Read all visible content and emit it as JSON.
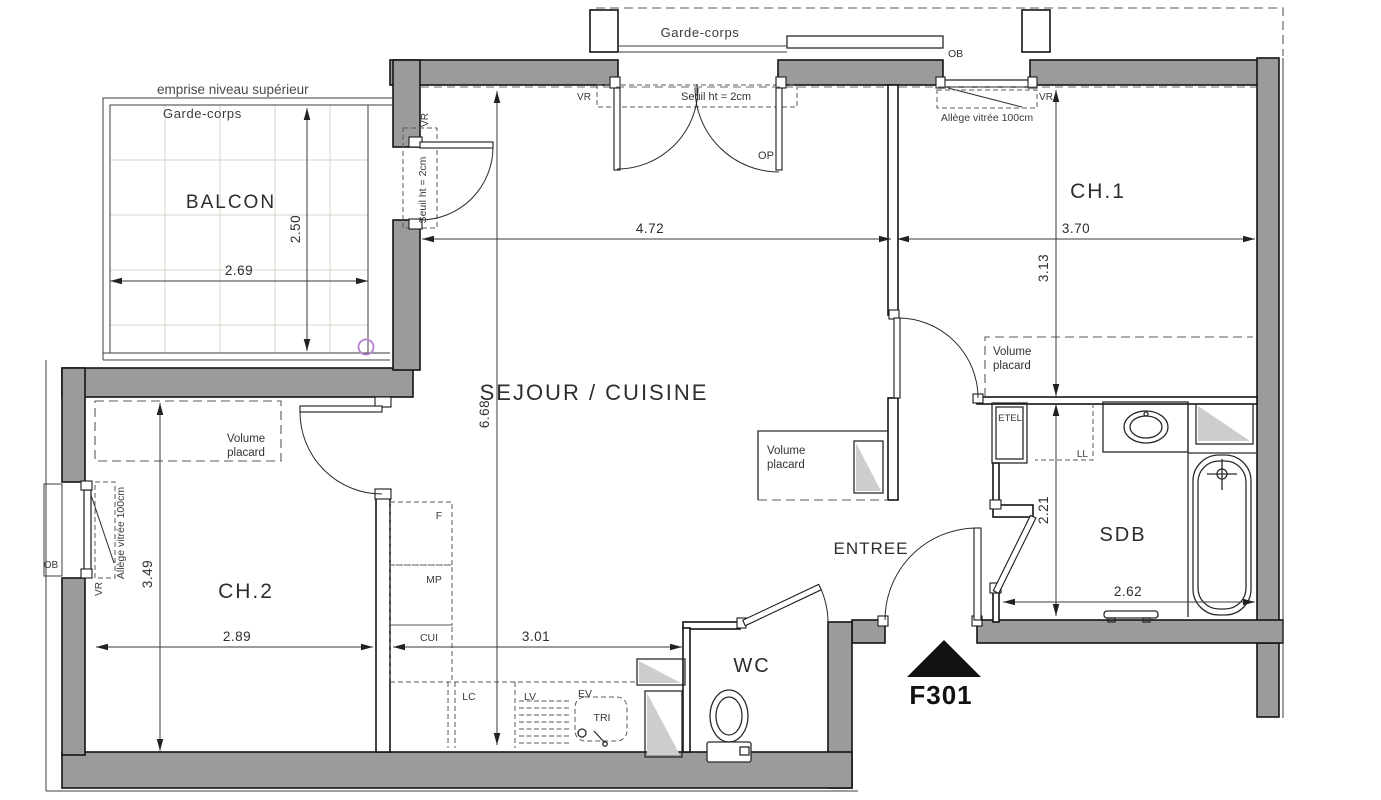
{
  "unit": {
    "id": "F301"
  },
  "rooms": {
    "balcon": "BALCON",
    "sejour": "SEJOUR / CUISINE",
    "ch1": "CH.1",
    "ch2": "CH.2",
    "sdb": "SDB",
    "wc": "WC",
    "entree": "ENTREE"
  },
  "dims": {
    "balcon_width": "2.69",
    "balcon_depth": "2.50",
    "sejour_width": "4.72",
    "sejour_depth": "6.68",
    "ch1_width": "3.70",
    "ch1_depth": "3.13",
    "ch2_width": "2.89",
    "ch2_depth": "3.49",
    "cuisine_width": "3.01",
    "sdb_width": "2.62",
    "sdb_depth": "2.21"
  },
  "labels": {
    "emprise": "emprise niveau supérieur",
    "garde_corps": "Garde-corps",
    "seuil": "Seuil ht = 2cm",
    "allege": "Allège vitrée 100cm",
    "volume": "Volume",
    "placard": "placard",
    "vr": "VR",
    "ob": "OB",
    "op": "OP",
    "etel": "ETEL",
    "ll": "LL",
    "f": "F",
    "mp": "MP",
    "cui": "CUI",
    "lc": "LC",
    "lv": "LV",
    "ev": "EV",
    "tri": "TRI"
  },
  "colors": {
    "wall": "#9b9b9b",
    "duct": "#cdcdcd",
    "grid": "#d9d5c8",
    "accent_circle": "#b77fd1",
    "ink": "#111111"
  }
}
